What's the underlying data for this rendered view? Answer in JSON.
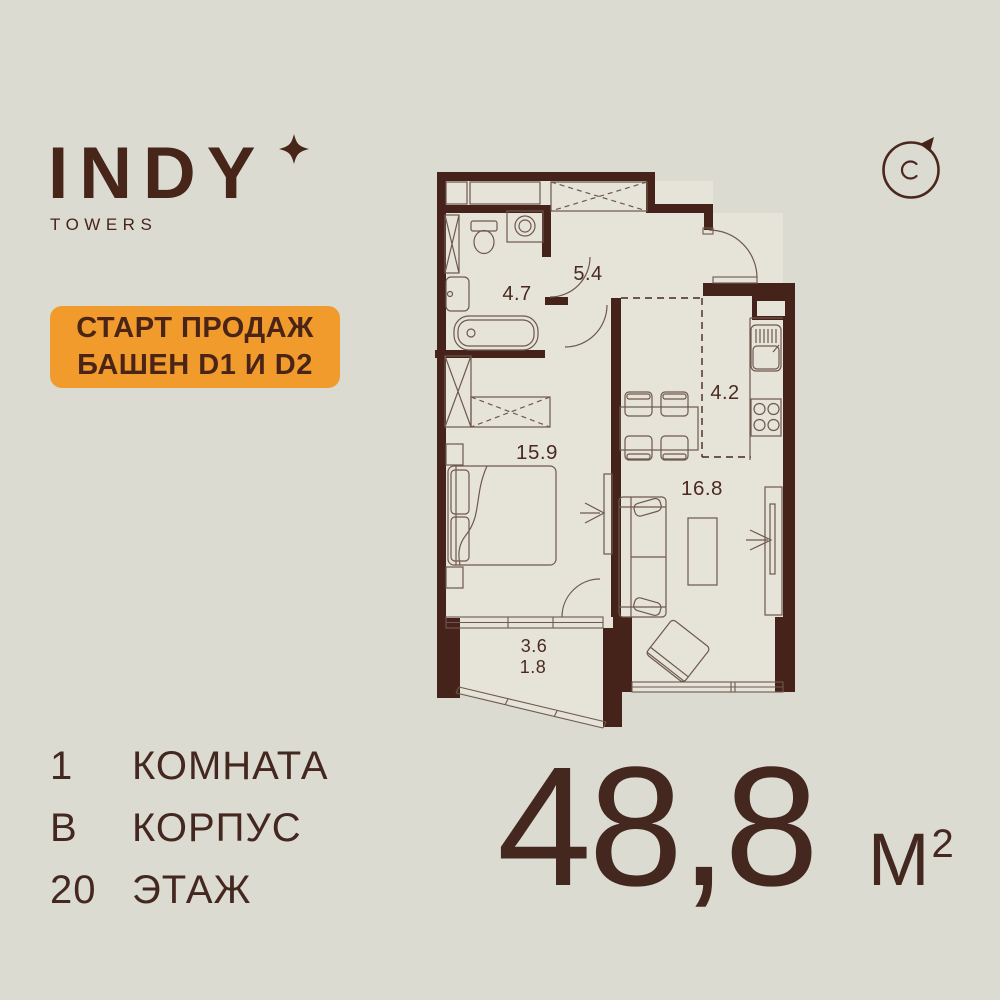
{
  "colors": {
    "background": "#dcdbd2",
    "floor": "#e6e3d9",
    "wall": "#45231a",
    "ink": "#4a2a20",
    "accent": "#f09b2b"
  },
  "brand": {
    "name": "INDY",
    "subtitle": "TOWERS"
  },
  "promo_badge": {
    "line1": "СТАРТ ПРОДАЖ",
    "line2": "БАШЕН D1 И D2"
  },
  "compass": {
    "letter": "C"
  },
  "floor_plan": {
    "rooms": [
      {
        "id": "bathroom",
        "area": "4.7"
      },
      {
        "id": "hallway",
        "area": "5.4"
      },
      {
        "id": "kitchen",
        "area": "4.2"
      },
      {
        "id": "bedroom",
        "area": "15.9"
      },
      {
        "id": "living_room",
        "area": "16.8"
      },
      {
        "id": "balcony",
        "area": "3.6",
        "area_reduced": "1.8"
      }
    ]
  },
  "specs": [
    {
      "value": "1",
      "label": "КОМНАТА"
    },
    {
      "value": "В",
      "label": "КОРПУС"
    },
    {
      "value": "20",
      "label": "ЭТАЖ"
    }
  ],
  "total_area": {
    "value": "48,8",
    "unit": "М",
    "unit_exponent": "2"
  }
}
